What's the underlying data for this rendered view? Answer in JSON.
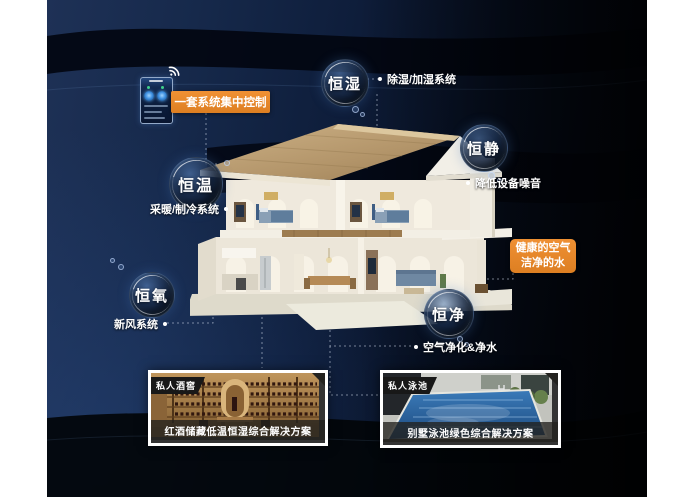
{
  "control": {
    "label": "一套系统集中控制",
    "icons": [
      "wifi-icon",
      "smart-home-app"
    ]
  },
  "highlight": {
    "line1": "健康的空气",
    "line2": "洁净的水"
  },
  "bubbles": [
    {
      "label": "恒湿",
      "desc": "除湿/加湿系统"
    },
    {
      "label": "恒静",
      "desc": "降低设备噪音"
    },
    {
      "label": "恒温",
      "desc": "采暖/制冷系统"
    },
    {
      "label": "恒氧",
      "desc": "新风系统"
    },
    {
      "label": "恒净",
      "desc": "空气净化&净水"
    }
  ],
  "cards": [
    {
      "badge": "私人酒窖",
      "caption": "红酒储藏低温恒湿综合解决方案"
    },
    {
      "badge": "私人泳池",
      "caption": "别墅泳池绿色综合解决方案"
    }
  ],
  "colors": {
    "accent_orange": "#E8872B",
    "panel_navy": "#0E1D3A",
    "panel_black": "#03060E",
    "bubble_glow": "#5A82B9",
    "text_white": "#FFFFFF"
  }
}
